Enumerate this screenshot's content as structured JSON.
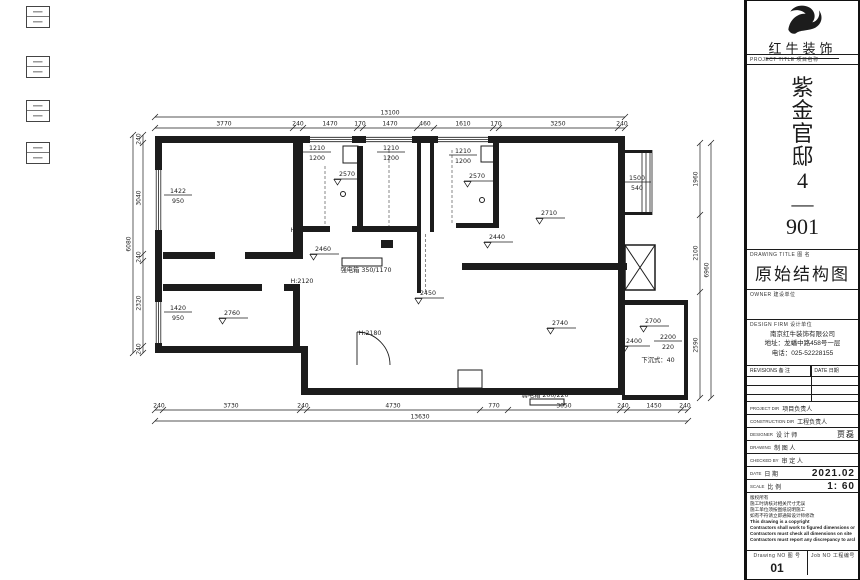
{
  "brand": {
    "name": "红牛装饰",
    "logo_icon": "bull-logo"
  },
  "titleblock": {
    "project_label": "PROJECT TITLE  项目名称",
    "project_name_chars": [
      "紫",
      "金",
      "官",
      "邸",
      "4",
      "—",
      "901"
    ],
    "drawing_title_label": "DRAWING TITLE  图 名",
    "drawing_title": "原始结构图",
    "owner_label": "OWNER  建设单位",
    "firm_label": "DESIGN FIRM  设计单位",
    "firm_lines": [
      "南京红牛装饰有限公司",
      "地址：龙蟠中路458号一层",
      "电话：025-52228155"
    ],
    "revisions": {
      "col1": "REVISIONS  备 注",
      "col2": "DATE  日期",
      "empty_rows": 3
    },
    "personnel": [
      {
        "en": "PROJECT DIR",
        "zh": "项目负责人",
        "value": "",
        "big": false
      },
      {
        "en": "CONSTRUCTION DIR",
        "zh": "工程负责人",
        "value": "",
        "big": false
      },
      {
        "en": "DESIGNER",
        "zh": "设 计 师",
        "value": "贾磊",
        "big": false
      },
      {
        "en": "DRAWING",
        "zh": "制 图 人",
        "value": "",
        "big": false
      },
      {
        "en": "CHECKED BY",
        "zh": "审 定 人",
        "value": "",
        "big": false
      },
      {
        "en": "DATE",
        "zh": "日 期",
        "value": "2021.02",
        "big": true
      },
      {
        "en": "SCALE",
        "zh": "比 例",
        "value": "1: 60",
        "big": true
      }
    ],
    "notes": [
      "版权所有",
      "施工时请核对相关尺寸无误",
      "施工单位须按图纸说明施工",
      "如有不符请立即通知设计师修改",
      "This drawing is a copyright",
      "Contractors shall work to figured dimensions only",
      "Contractors must check all dimensions on site",
      "Contractors must report any discrepancy to architects"
    ],
    "drawing_no_label": "Drawing NO  图 号",
    "drawing_no": "01",
    "job_no_label": "Job NO  工程编号"
  },
  "plan": {
    "labels": [
      {
        "t": "1422/950",
        "x": 178,
        "y": 193,
        "type": "frac"
      },
      {
        "t": "1420/950",
        "x": 178,
        "y": 310,
        "type": "frac"
      },
      {
        "t": "1210/1200",
        "x": 317,
        "y": 150,
        "type": "frac"
      },
      {
        "t": "1210/1200",
        "x": 391,
        "y": 150,
        "type": "frac"
      },
      {
        "t": "1210/1200",
        "x": 463,
        "y": 153,
        "type": "frac"
      },
      {
        "t": "1500/540",
        "x": 637,
        "y": 180,
        "type": "frac"
      },
      {
        "t": "2200/220",
        "x": 668,
        "y": 339,
        "type": "frac"
      },
      {
        "t": "2570",
        "x": 347,
        "y": 176,
        "type": "level"
      },
      {
        "t": "2570",
        "x": 477,
        "y": 178,
        "type": "level"
      },
      {
        "t": "2710",
        "x": 549,
        "y": 215,
        "type": "level"
      },
      {
        "t": "2440",
        "x": 497,
        "y": 239,
        "type": "level"
      },
      {
        "t": "2460",
        "x": 323,
        "y": 251,
        "type": "level"
      },
      {
        "t": "2450",
        "x": 428,
        "y": 295,
        "type": "level"
      },
      {
        "t": "2740",
        "x": 560,
        "y": 325,
        "type": "level"
      },
      {
        "t": "2760",
        "x": 232,
        "y": 315,
        "type": "level"
      },
      {
        "t": "2700",
        "x": 653,
        "y": 323,
        "type": "level"
      },
      {
        "t": "2400",
        "x": 634,
        "y": 343,
        "type": "level"
      },
      {
        "t": "下沉式：40",
        "x": 658,
        "y": 362,
        "type": "plain",
        "s": 7
      },
      {
        "t": "H:2120",
        "x": 302,
        "y": 232,
        "type": "plain",
        "s": 7.5
      },
      {
        "t": "H:2120",
        "x": 302,
        "y": 283,
        "type": "plain",
        "s": 7.5
      },
      {
        "t": "H:2180",
        "x": 370,
        "y": 335,
        "type": "plain",
        "s": 7.5
      },
      {
        "t": "强电箱 350/1170",
        "x": 366,
        "y": 272,
        "type": "plain",
        "s": 6
      },
      {
        "t": "弱电箱 200/220",
        "x": 545,
        "y": 397,
        "type": "plain",
        "s": 6
      }
    ],
    "dims": [
      {
        "dir": "h",
        "y": 117,
        "x1": 155,
        "x2": 625,
        "ticks": [
          155,
          625
        ],
        "labels": [
          {
            "t": "13100",
            "x": 390
          }
        ]
      },
      {
        "dir": "h",
        "y": 128,
        "x1": 155,
        "x2": 625,
        "ticks": [
          155,
          293,
          303,
          357,
          363,
          417,
          434,
          493,
          499,
          618,
          625
        ],
        "labels": [
          {
            "t": "3770",
            "x": 224
          },
          {
            "t": "240",
            "x": 298
          },
          {
            "t": "1470",
            "x": 330
          },
          {
            "t": "170",
            "x": 360
          },
          {
            "t": "1470",
            "x": 390
          },
          {
            "t": "460",
            "x": 425
          },
          {
            "t": "1610",
            "x": 463
          },
          {
            "t": "170",
            "x": 496
          },
          {
            "t": "3250",
            "x": 558
          },
          {
            "t": "240",
            "x": 622
          }
        ]
      },
      {
        "dir": "h",
        "y": 410,
        "x1": 155,
        "x2": 688,
        "ticks": [
          155,
          163,
          300,
          307,
          480,
          508,
          620,
          627,
          681,
          688
        ],
        "labels": [
          {
            "t": "240",
            "x": 159
          },
          {
            "t": "3730",
            "x": 231
          },
          {
            "t": "240",
            "x": 303
          },
          {
            "t": "4730",
            "x": 393
          },
          {
            "t": "770",
            "x": 494
          },
          {
            "t": "3050",
            "x": 564
          },
          {
            "t": "240",
            "x": 623
          },
          {
            "t": "1450",
            "x": 654
          },
          {
            "t": "240",
            "x": 685
          }
        ]
      },
      {
        "dir": "h",
        "y": 421,
        "x1": 155,
        "x2": 688,
        "ticks": [
          155,
          688
        ],
        "labels": [
          {
            "t": "13630",
            "x": 420
          }
        ]
      },
      {
        "dir": "v",
        "x": 143,
        "y1": 135,
        "y2": 353,
        "ticks": [
          135,
          143,
          254,
          261,
          346,
          353
        ],
        "labels": [
          {
            "t": "240",
            "y": 139
          },
          {
            "t": "3040",
            "y": 198
          },
          {
            "t": "240",
            "y": 257
          },
          {
            "t": "2320",
            "y": 303
          },
          {
            "t": "240",
            "y": 349
          }
        ]
      },
      {
        "dir": "v",
        "x": 133,
        "y1": 135,
        "y2": 353,
        "ticks": [
          135,
          353
        ],
        "labels": [
          {
            "t": "6080",
            "y": 244
          }
        ]
      },
      {
        "dir": "v",
        "x": 700,
        "y1": 143,
        "y2": 398,
        "ticks": [
          143,
          215,
          292,
          398
        ],
        "labels": [
          {
            "t": "1960",
            "y": 179
          },
          {
            "t": "2100",
            "y": 253
          },
          {
            "t": "2590",
            "y": 345
          }
        ]
      },
      {
        "dir": "v",
        "x": 711,
        "y1": 143,
        "y2": 398,
        "ticks": [
          143,
          398
        ],
        "labels": [
          {
            "t": "6960",
            "y": 270
          }
        ]
      }
    ]
  },
  "colors": {
    "line": "#1c1c1c",
    "background": "#ffffff"
  }
}
